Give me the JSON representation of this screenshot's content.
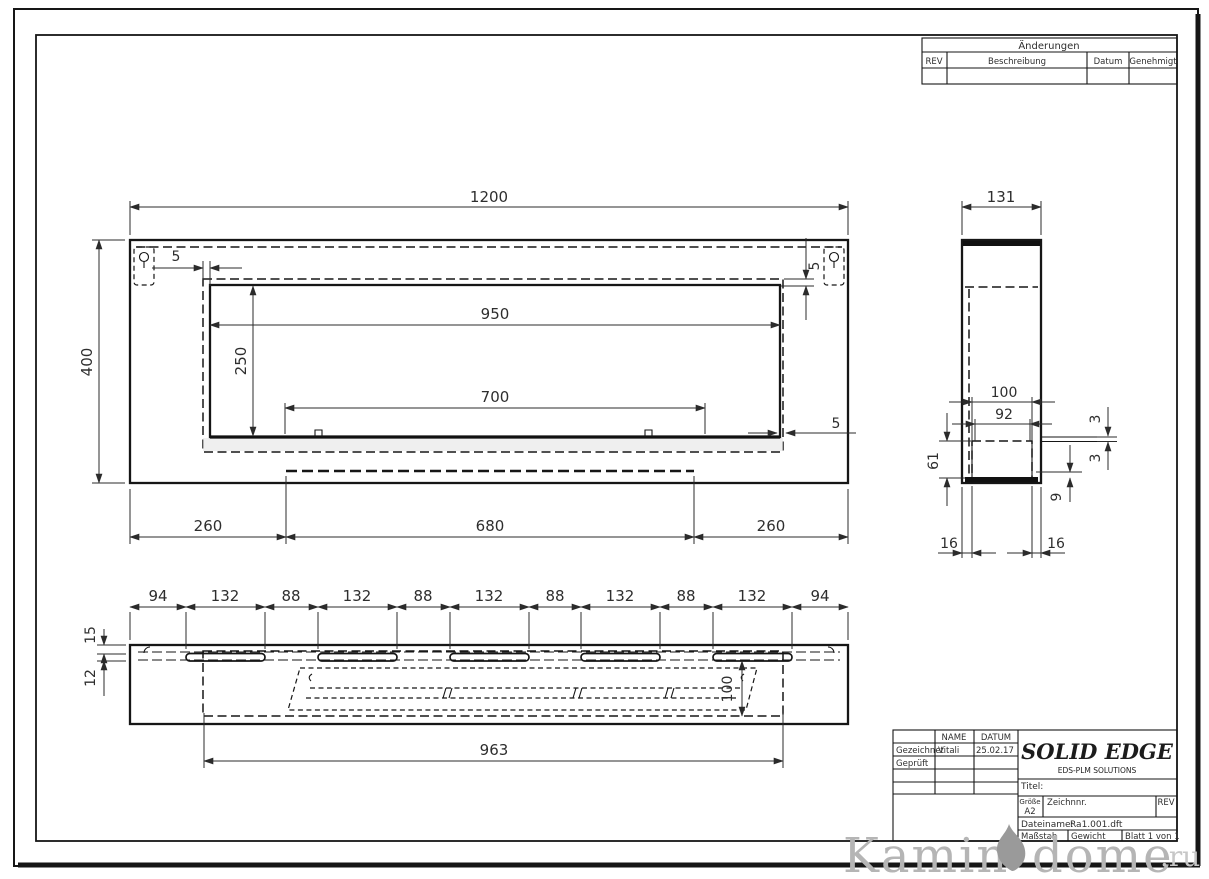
{
  "sheet": {
    "changes_table": {
      "title": "Änderungen",
      "columns": {
        "rev": "REV",
        "description": "Beschreibung",
        "date": "Datum",
        "approved": "Genehmigt"
      }
    },
    "title_block": {
      "name_col": "NAME",
      "date_col": "DATUM",
      "drawn_label": "Gezeichnet",
      "drawn_name": "Vitali",
      "drawn_date": "25.02.17",
      "checked_label": "Geprüft",
      "brand": "SOLID EDGE",
      "brand_sub": "EDS-PLM SOLUTIONS",
      "title_label": "Titel:",
      "size_label": "Größe",
      "size_value": "A2",
      "drawing_no_label": "Zeichnnr.",
      "rev_label": "REV",
      "filename_label": "Dateiname:",
      "filename_value": "Ra1.001.dft",
      "scale_label": "Maßstab",
      "weight_label": "Gewicht",
      "sheet_info": "Blatt 1 von 1"
    },
    "watermark": {
      "word1": "Kamin",
      "word2": "dome",
      "tld": ".ru"
    }
  },
  "views": {
    "front": {
      "dims": {
        "total_width": "1200",
        "total_height": "400",
        "inset_left": "5",
        "inset_right": "5",
        "opening_width": "950",
        "opening_height": "250",
        "burner_width": "700",
        "gap_right": "5",
        "bottom_left": "260",
        "bottom_center": "680",
        "bottom_right": "260"
      }
    },
    "side": {
      "dims": {
        "depth": "131",
        "channel_outer": "100",
        "channel_inner": "92",
        "thickness_top": "3",
        "thickness_bottom": "3",
        "channel_height": "61",
        "lip": "9",
        "offset_left": "16",
        "offset_right": "16"
      }
    },
    "bottom": {
      "dims": {
        "segments": [
          "94",
          "132",
          "88",
          "132",
          "88",
          "132",
          "88",
          "132",
          "88",
          "132",
          "94"
        ],
        "edge_offset": "15",
        "slot_width": "12",
        "channel_depth": "100",
        "opening_length": "963"
      }
    }
  }
}
